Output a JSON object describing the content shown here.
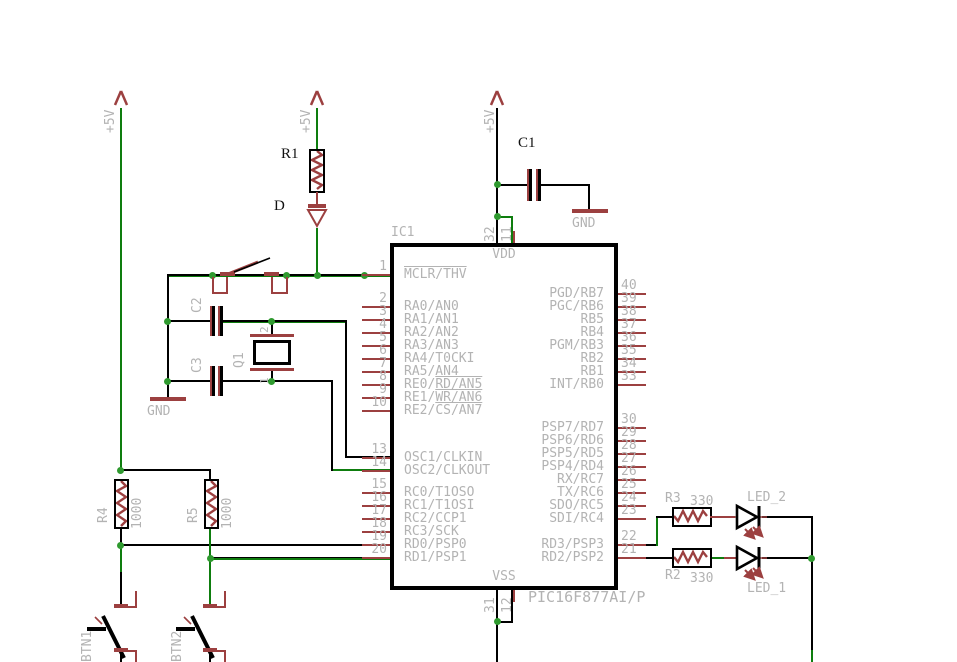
{
  "power": {
    "v5": "+5V",
    "gnd": "GND"
  },
  "ic": {
    "ref": "IC1",
    "part": "PIC16F877AI/P",
    "vdd": "VDD",
    "vss": "VSS",
    "top_pins": [
      {
        "num": "32"
      },
      {
        "num": "11"
      }
    ],
    "bottom_pins": [
      {
        "num": "31"
      },
      {
        "num": "12"
      }
    ],
    "left_pins": [
      {
        "num": "1",
        "pre": "",
        "ov": "MCLR/THV",
        "y": 275
      },
      {
        "num": "2",
        "pre": "RA0/AN0",
        "ov": "",
        "y": 307
      },
      {
        "num": "3",
        "pre": "RA1/AN1",
        "ov": "",
        "y": 320
      },
      {
        "num": "4",
        "pre": "RA2/AN2",
        "ov": "",
        "y": 333
      },
      {
        "num": "5",
        "pre": "RA3/AN3",
        "ov": "",
        "y": 346
      },
      {
        "num": "6",
        "pre": "RA4/T0CKI",
        "ov": "",
        "y": 359
      },
      {
        "num": "7",
        "pre": "RA5/AN4",
        "ov": "",
        "y": 372
      },
      {
        "num": "8",
        "pre": "RE0/",
        "ov": "RD/AN5",
        "y": 385
      },
      {
        "num": "9",
        "pre": "RE1/",
        "ov": "WR/AN6",
        "y": 398
      },
      {
        "num": "10",
        "pre": "RE2/",
        "ov": "CS/AN7",
        "y": 411
      },
      {
        "num": "13",
        "pre": "OSC1/CLKIN",
        "ov": "",
        "y": 458
      },
      {
        "num": "14",
        "pre": "OSC2/CLKOUT",
        "ov": "",
        "y": 471
      },
      {
        "num": "15",
        "pre": "RC0/T1OSO",
        "ov": "",
        "y": 493
      },
      {
        "num": "16",
        "pre": "RC1/T1OSI",
        "ov": "",
        "y": 506
      },
      {
        "num": "17",
        "pre": "RC2/CCP1",
        "ov": "",
        "y": 519
      },
      {
        "num": "18",
        "pre": "RC3/SCK",
        "ov": "",
        "y": 532
      },
      {
        "num": "19",
        "pre": "RD0/PSP0",
        "ov": "",
        "y": 545
      },
      {
        "num": "20",
        "pre": "RD1/PSP1",
        "ov": "",
        "y": 558
      }
    ],
    "right_pins": [
      {
        "num": "40",
        "name": "PGD/RB7",
        "y": 294
      },
      {
        "num": "39",
        "name": "PGC/RB6",
        "y": 307
      },
      {
        "num": "38",
        "name": "RB5",
        "y": 320
      },
      {
        "num": "37",
        "name": "RB4",
        "y": 333
      },
      {
        "num": "36",
        "name": "PGM/RB3",
        "y": 346
      },
      {
        "num": "35",
        "name": "RB2",
        "y": 359
      },
      {
        "num": "34",
        "name": "RB1",
        "y": 372
      },
      {
        "num": "33",
        "name": "INT/RB0",
        "y": 385
      },
      {
        "num": "30",
        "name": "PSP7/RD7",
        "y": 428
      },
      {
        "num": "29",
        "name": "PSP6/RD6",
        "y": 441
      },
      {
        "num": "28",
        "name": "PSP5/RD5",
        "y": 454
      },
      {
        "num": "27",
        "name": "PSP4/RD4",
        "y": 467
      },
      {
        "num": "26",
        "name": "RX/RC7",
        "y": 480
      },
      {
        "num": "25",
        "name": "TX/RC6",
        "y": 493
      },
      {
        "num": "24",
        "name": "SDO/RC5",
        "y": 506
      },
      {
        "num": "23",
        "name": "SDI/RC4",
        "y": 519
      },
      {
        "num": "22",
        "name": "RD3/PSP3",
        "y": 545
      },
      {
        "num": "21",
        "name": "RD2/PSP2",
        "y": 558
      }
    ]
  },
  "components": {
    "r1": {
      "ref": "R1"
    },
    "d": {
      "ref": "D"
    },
    "c1": {
      "ref": "C1"
    },
    "c2": {
      "ref": "C2"
    },
    "c3": {
      "ref": "C3"
    },
    "q1": {
      "ref": "Q1",
      "pin2": "2",
      "pin1": "1"
    },
    "r4": {
      "ref": "R4",
      "value": "1000"
    },
    "r5": {
      "ref": "R5",
      "value": "1000"
    },
    "btn1": {
      "ref": "BTN1"
    },
    "btn2": {
      "ref": "BTN2"
    },
    "r3": {
      "ref": "R3",
      "value": "330"
    },
    "r2": {
      "ref": "R2",
      "value": "330"
    },
    "led2": {
      "ref": "LED_2"
    },
    "led1": {
      "ref": "LED_1"
    }
  },
  "colors": {
    "wire_green": "#0e7d0e",
    "junction_green": "#2f9a2f",
    "symbol_red": "#9c4040",
    "label_gray": "#b3b3b3",
    "wire_black": "#000000"
  }
}
